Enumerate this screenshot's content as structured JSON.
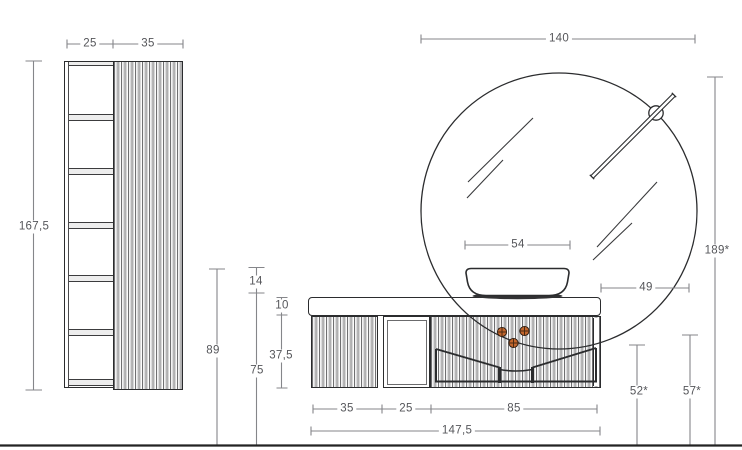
{
  "drawing_type": "bathroom furniture dimensioned elevation",
  "colors": {
    "outline": "#2b2c2e",
    "dimension_line": "#85868a",
    "dimension_text": "#55565a",
    "plumbing_marker": "#c2662d",
    "floor_line": "#232323"
  },
  "labels": {
    "cabinet_shelf_width": "25",
    "cabinet_door_width": "35",
    "cabinet_height": "167,5",
    "basin_rim_height": "89",
    "basin_height": "14",
    "worktop_height": "75",
    "top_frame_height": "10",
    "body_height": "37,5",
    "mirror_diameter": "140",
    "mirror_top_height": "189*",
    "mirror_side_overhang": "49",
    "basin_width": "54",
    "connection_left_height": "52*",
    "connection_right_height": "57*",
    "vanity_flute_width": "35",
    "vanity_open_width": "25",
    "vanity_basin_width": "85",
    "vanity_total_width": "147,5"
  }
}
